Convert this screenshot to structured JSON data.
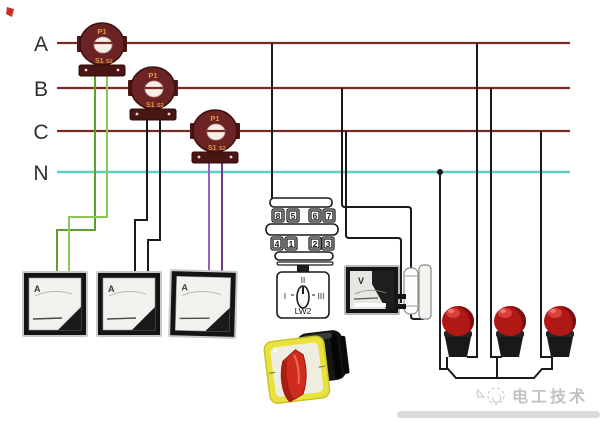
{
  "bus": {
    "labels": [
      "A",
      "B",
      "C",
      "N"
    ]
  },
  "current_transformers": {
    "primary_label": "P1",
    "secondary_terminal_1": "S1",
    "secondary_terminal_2": "S2"
  },
  "terminal_block": {
    "top_row": [
      "8",
      "5",
      "6",
      "7"
    ],
    "bottom_row": [
      "4",
      "1",
      "2",
      "3"
    ]
  },
  "selector_switch": {
    "position_left": "I",
    "position_top": "II",
    "position_right": "III",
    "model": "LW2"
  },
  "voltmeter": {
    "label": "V"
  },
  "ammeters": {
    "label_1": "A",
    "label_2": "A",
    "label_3": "A"
  },
  "watermark": {
    "text": "电工技术"
  },
  "colors": {
    "phase_line": "#7a2a26",
    "neutral_line": "#5fcdc3",
    "ct_body": "#6b2423",
    "ct_text": "#dd9b43",
    "wire_green_1": "#5f9e33",
    "wire_green_2": "#8cc653",
    "wire_black": "#1a1a1a",
    "wire_purple_1": "#9a5fb5",
    "wire_purple_2": "#6b3b8f",
    "lamp_red": "#b01816",
    "switch_plate_yellow": "#e8e33c",
    "switch_handle_red": "#cf2b1f",
    "watermark_gray": "#c2c2c2"
  }
}
